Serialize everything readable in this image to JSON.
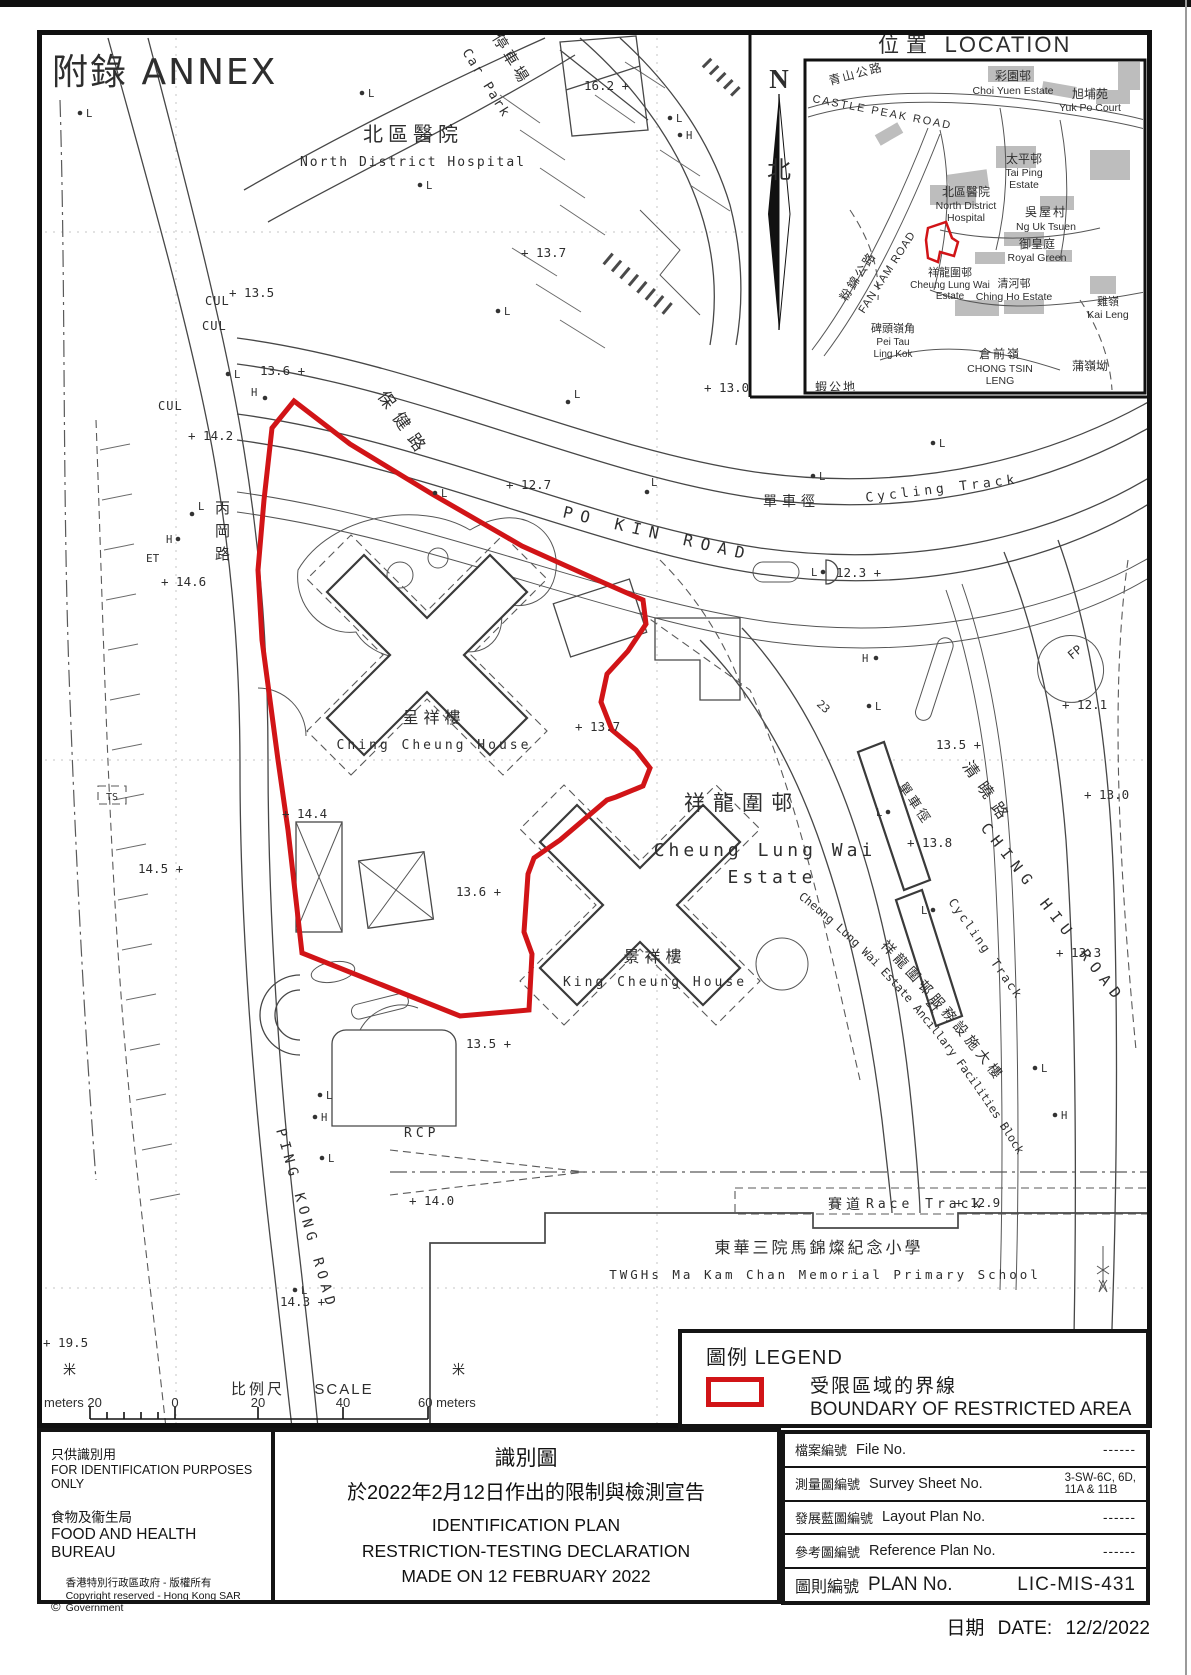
{
  "page": {
    "annex": "附錄 ANNEX"
  },
  "m": {
    "carpark_c": "停車場",
    "carpark_e": "Car Park",
    "hosp_c": "北區醫院",
    "hosp_e": "North District Hospital",
    "pokin_c": "保健路",
    "pokin_e": "PO KIN ROAD",
    "pingkong_c": "丙岡路",
    "pingkong_e": "PING KONG ROAD",
    "chinghiu_c": "清曉路",
    "chinghiu_e": "CHING HIU ROAD",
    "cycling_c": "單車徑",
    "cycling_e": "Cycling Track",
    "race_c": "賽道",
    "race_e": "Race Track",
    "estate_c": "祥龍圍邨",
    "estate_e1": "Cheung Lung Wai",
    "estate_e2": "Estate",
    "cch_c": "呈祥樓",
    "cch_e": "Ching Cheung House",
    "kch_c": "景祥樓",
    "kch_e": "King Cheung House",
    "school_c": "東華三院馬錦燦紀念小學",
    "school_e": "TWGHs Ma Kam Chan Memorial Primary School",
    "anc_c": "祥龍圍邨服務設施大樓",
    "anc_e": "Cheung Lung Wai Estate Ancillary Facilities Block",
    "rcp": "RCP",
    "cul": "CUL",
    "et": "ET",
    "ts": "TS",
    "fp": "FP",
    "n21": "21",
    "n23": "23",
    "L": "L",
    "H": "H",
    "spots": [
      "16.2 +",
      "+ 13.7",
      "+ 13.5",
      "13.6 +",
      "+ 14.2",
      "+ 14.6",
      "+ 12.7",
      "+ 13.0",
      "12.3 +",
      "+ 13.7",
      "13.6 +",
      "+ 12.1",
      "13.5 +",
      "+ 13.8",
      "+ 13.0",
      "+ 13.3",
      "+ 14.0",
      "14.3 +",
      "+ 12.9",
      "+ 19.5",
      "14.5 +",
      "+ 14.4",
      "13.5 +"
    ]
  },
  "inset": {
    "title_c": "位置",
    "title_e": "LOCATION",
    "n": "N",
    "north_c": "北",
    "castle_c": "青山公路",
    "castle_e": "CASTLE PEAK ROAD",
    "choi_c": "彩園邨",
    "choi_e": "Choi Yuen Estate",
    "yuk_c": "旭埔苑",
    "yuk_e": "Yuk Po Court",
    "taiping_c": "太平邨",
    "taiping_e1": "Tai Ping",
    "taiping_e2": "Estate",
    "ndh_c": "北區醫院",
    "ndh_e1": "North District",
    "ndh_e2": "Hospital",
    "ng_c": "吳屋村",
    "ng_e": "Ng Uk Tsuen",
    "royal_c": "御皇庭",
    "royal_e": "Royal Green",
    "fankam_c": "粉錦公路",
    "fankam_e": "FAN KAM ROAD",
    "clw_c": "祥龍圍邨",
    "clw_e1": "Cheung Lung Wai",
    "clw_e2": "Estate",
    "chingho_c": "清河邨",
    "chingho_e": "Ching Ho Estate",
    "kai_c": "雞嶺",
    "kai_e": "Kai Leng",
    "peitau_c": "碑頭嶺角",
    "peitau_e1": "Pei Tau",
    "peitau_e2": "Ling Kok",
    "chongtsin_c": "倉前嶺",
    "chongtsin_e1": "CHONG TSIN",
    "chongtsin_e2": "LENG",
    "po_c": "蒲嶺坳",
    "ha_c": "蝦公地"
  },
  "scale": {
    "c": "比例尺",
    "e": "SCALE",
    "m_left": "米",
    "m_right": "米",
    "left": "meters 20",
    "n0": "0",
    "n20": "20",
    "n40": "40",
    "right": "60 meters"
  },
  "legend": {
    "title_c": "圖例",
    "title_e": "LEGEND",
    "boundary_c": "受限區域的界線",
    "boundary_e": "BOUNDARY OF RESTRICTED AREA",
    "symbol_color": "#d11417"
  },
  "table": {
    "rows": [
      {
        "c": "檔案編號",
        "e": "File No.",
        "v": "------"
      },
      {
        "c": "測量圖編號",
        "e": "Survey Sheet No.",
        "v": "3-SW-6C, 6D,",
        "v2": "11A & 11B"
      },
      {
        "c": "發展藍圖編號",
        "e": "Layout Plan No.",
        "v": "------"
      },
      {
        "c": "參考圖編號",
        "e": "Reference Plan No.",
        "v": "------"
      },
      {
        "c": "圖則編號",
        "e": "PLAN No.",
        "v": "LIC-MIS-431"
      }
    ],
    "date_c": "日期",
    "date_e": "DATE:",
    "date_v": "12/2/2022"
  },
  "footer": {
    "left": {
      "l1": "只供識別用",
      "l2": "FOR IDENTIFICATION PURPOSES ONLY",
      "l3": "食物及衞生局",
      "l4": "FOOD AND HEALTH BUREAU",
      "csym": "©",
      "c1": "香港特別行政區政府 - 版權所有",
      "c2": "Copyright reserved - Hong Kong SAR Government"
    },
    "center": {
      "t1": "識別圖",
      "t2": "於2022年2月12日作出的限制與檢測宣告",
      "t3": "IDENTIFICATION PLAN",
      "t4": "RESTRICTION-TESTING DECLARATION",
      "t5": "MADE ON 12 FEBRUARY 2022"
    }
  }
}
